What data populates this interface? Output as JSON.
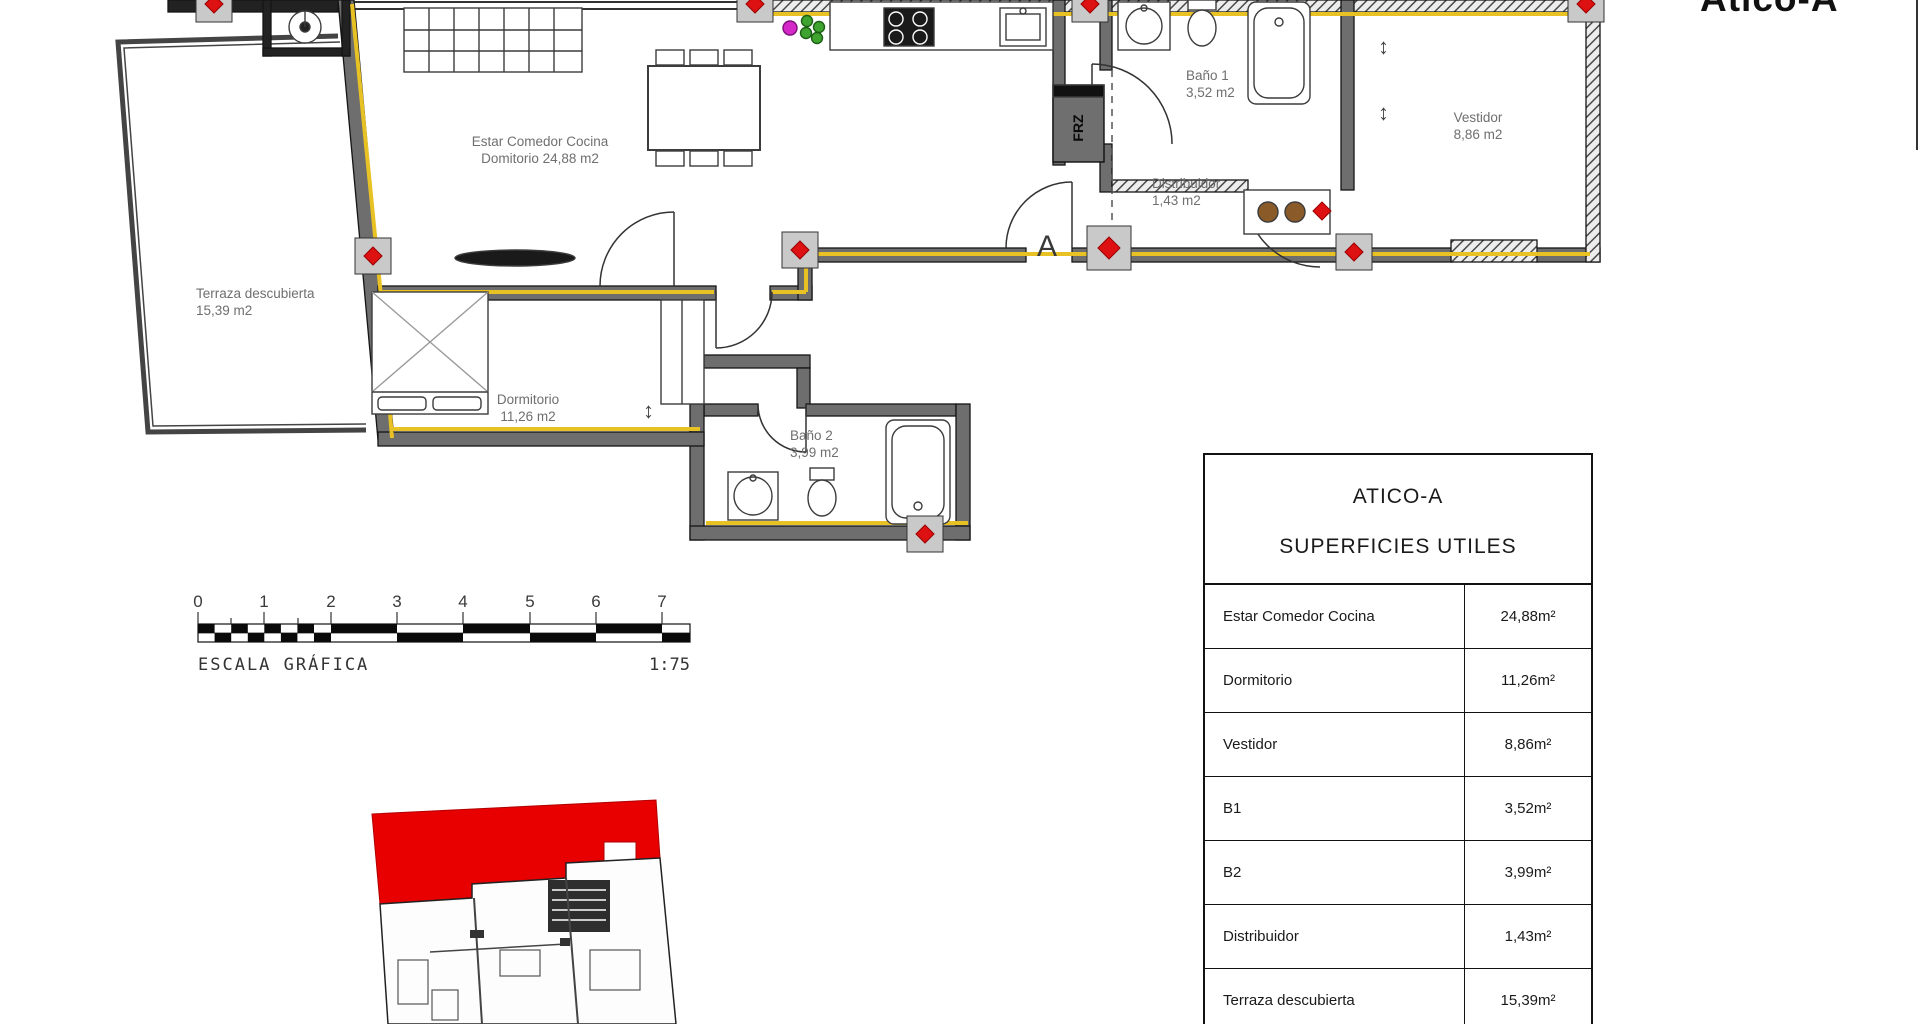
{
  "sheet": {
    "title": "Atico-A"
  },
  "plan": {
    "labels": {
      "estar": {
        "l1": "Estar Comedor Cocina",
        "l2": "Domitorio 24,88 m2"
      },
      "terraza": {
        "l1": "Terraza descubierta",
        "l2": "15,39 m2"
      },
      "dormitorio": {
        "l1": "Dormitorio",
        "l2": "11,26 m2"
      },
      "bano2": {
        "l1": "Baño 2",
        "l2": "3,99 m2"
      },
      "bano1": {
        "l1": "Baño 1",
        "l2": "3,52 m2"
      },
      "distribuidor": {
        "l1": "Distribuidor",
        "l2": "1,43 m2"
      },
      "vestidor": {
        "l1": "Vestidor",
        "l2": "8,86 m2"
      },
      "section": "A",
      "fridge": "FRZ"
    },
    "glyphs": {
      "updown": "↕"
    }
  },
  "scalebar": {
    "ticks": [
      "0",
      "1",
      "2",
      "3",
      "4",
      "5",
      "6",
      "7"
    ],
    "caption": "ESCALA GRÁFICA",
    "ratio": "1:75"
  },
  "table": {
    "title1": "ATICO-A",
    "title2": "SUPERFICIES UTILES",
    "rows": [
      {
        "name": "Estar Comedor Cocina",
        "value": "24,88m²"
      },
      {
        "name": "Dormitorio",
        "value": "11,26m²"
      },
      {
        "name": "Vestidor",
        "value": "8,86m²"
      },
      {
        "name": "B1",
        "value": "3,52m²"
      },
      {
        "name": "B2",
        "value": "3,99m²"
      },
      {
        "name": "Distribuidor",
        "value": "1,43m²"
      },
      {
        "name": "Terraza descubierta",
        "value": "15,39m²"
      }
    ]
  },
  "colors": {
    "insulation": "#e8c225",
    "marker": "#dd1111",
    "highlight": "#e80000",
    "wall": "#6e6e6e"
  }
}
